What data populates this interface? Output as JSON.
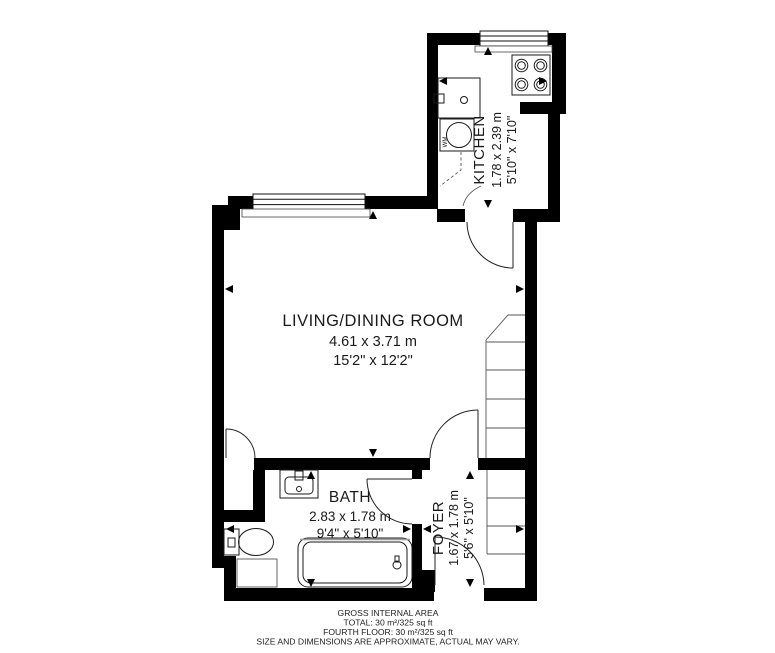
{
  "rooms": {
    "living": {
      "name": "LIVING/DINING ROOM",
      "metric": "4.61 x 3.71 m",
      "imperial": "15'2\" x 12'2\""
    },
    "kitchen": {
      "name": "KITCHEN",
      "metric": "1.78 x 2.39 m",
      "imperial": "5'10\" x 7'10\""
    },
    "bath": {
      "name": "BATH",
      "metric": "2.83 x 1.78 m",
      "imperial": "9'4\" x 5'10\""
    },
    "foyer": {
      "name": "FOYER",
      "metric": "1.67 x 1.78 m",
      "imperial": "5'6\" x 5'10\""
    }
  },
  "appliances": {
    "washing_machine_label": "WM"
  },
  "footer": {
    "line1": "GROSS INTERNAL AREA",
    "line2": "TOTAL: 30 m²/325 sq ft",
    "line3": "FOURTH FLOOR: 30 m²/325 sq ft",
    "line4": "SIZE AND DIMENSIONS ARE APPROXIMATE, ACTUAL MAY VARY."
  },
  "colors": {
    "wall": "#000000",
    "line": "#1a1a1a",
    "background": "#ffffff"
  }
}
